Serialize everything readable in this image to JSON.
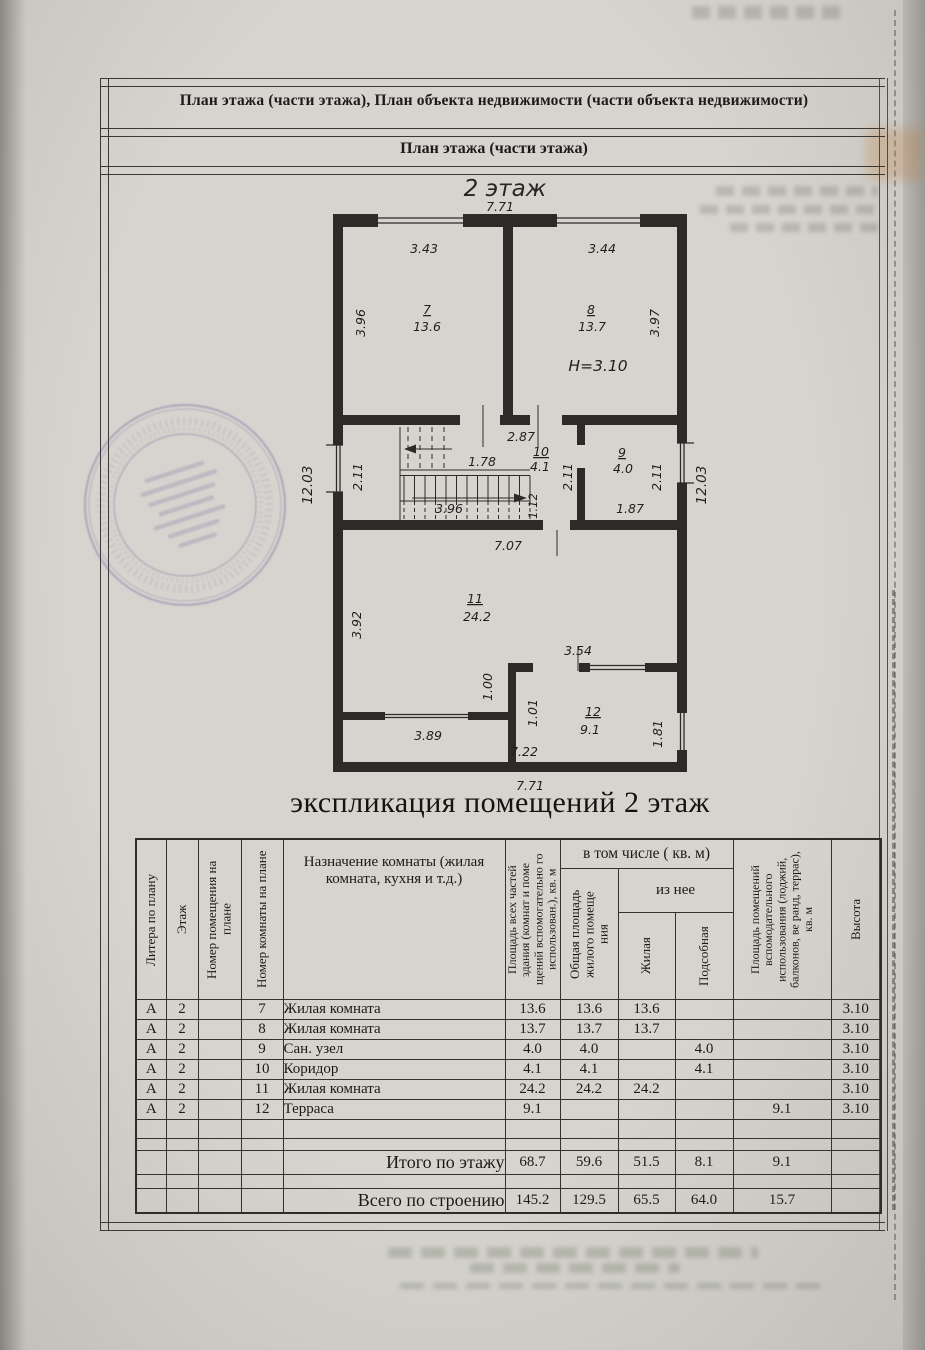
{
  "document": {
    "header_line1": "План этажа (части этажа), План объекта недвижимости (части объекта недвижимости)",
    "header_line2": "План этажа (части этажа)",
    "plan_floor_title": "2 этаж",
    "explication_title": "экспликация помещений 2  этаж"
  },
  "plan": {
    "labels": [
      {
        "t": "7.71",
        "x": 500,
        "y": 211
      },
      {
        "t": "3.43",
        "x": 424,
        "y": 253
      },
      {
        "t": "3.44",
        "x": 602,
        "y": 253
      },
      {
        "t": "3.96",
        "x": 365,
        "y": 323,
        "r": -90
      },
      {
        "t": "7",
        "x": 427,
        "y": 314,
        "u": 1
      },
      {
        "t": "13.6",
        "x": 427,
        "y": 331
      },
      {
        "t": "8",
        "x": 591,
        "y": 314,
        "u": 1
      },
      {
        "t": "13.7",
        "x": 592,
        "y": 331
      },
      {
        "t": "3.97",
        "x": 659,
        "y": 323,
        "r": -90
      },
      {
        "t": "H=3.10",
        "x": 598,
        "y": 371,
        "s": 15.5
      },
      {
        "t": "12.03",
        "x": 312,
        "y": 485,
        "r": -90,
        "s": 13.5
      },
      {
        "t": "2.11",
        "x": 362,
        "y": 477,
        "r": -90
      },
      {
        "t": "2.87",
        "x": 521,
        "y": 441
      },
      {
        "t": "1.78",
        "x": 482,
        "y": 466
      },
      {
        "t": "10",
        "x": 541,
        "y": 456,
        "u": 1
      },
      {
        "t": "4.1",
        "x": 540,
        "y": 471
      },
      {
        "t": "2.11",
        "x": 572,
        "y": 477,
        "r": -90
      },
      {
        "t": "9",
        "x": 622,
        "y": 457,
        "u": 1
      },
      {
        "t": "4.0",
        "x": 623,
        "y": 473
      },
      {
        "t": "2.11",
        "x": 661,
        "y": 477,
        "r": -90
      },
      {
        "t": "12.03",
        "x": 706,
        "y": 485,
        "r": -90,
        "s": 13.5
      },
      {
        "t": "3.96",
        "x": 449,
        "y": 513
      },
      {
        "t": "1.12",
        "x": 537,
        "y": 506,
        "r": -90,
        "s": 11.5
      },
      {
        "t": "1.87",
        "x": 630,
        "y": 513
      },
      {
        "t": "7.07",
        "x": 508,
        "y": 550
      },
      {
        "t": "11",
        "x": 475,
        "y": 603,
        "u": 1
      },
      {
        "t": "24.2",
        "x": 477,
        "y": 621
      },
      {
        "t": "3.92",
        "x": 361,
        "y": 625,
        "r": -90
      },
      {
        "t": "3.54",
        "x": 578,
        "y": 655
      },
      {
        "t": "1.00",
        "x": 492,
        "y": 687,
        "r": -90
      },
      {
        "t": "1.01",
        "x": 537,
        "y": 713,
        "r": -90
      },
      {
        "t": "12",
        "x": 593,
        "y": 716,
        "u": 1
      },
      {
        "t": "9.1",
        "x": 590,
        "y": 734
      },
      {
        "t": "1.81",
        "x": 662,
        "y": 734,
        "r": -90
      },
      {
        "t": "3.89",
        "x": 428,
        "y": 740
      },
      {
        "t": "7.22",
        "x": 524,
        "y": 756
      },
      {
        "t": "7.71",
        "x": 530,
        "y": 790
      }
    ]
  },
  "stamp": {
    "present": true,
    "legible": false,
    "color": "#5f5694"
  },
  "table": {
    "headers": {
      "col1": "Литера по плану",
      "col2": "Этаж",
      "col3": "Номер помещения на плане",
      "col4": "Номер комнаты на плане",
      "col5": "Назначение комнаты (жилая комната, кухня и т.д.)",
      "col6": "Площадь всех частей здания (комнат и поме щений вспомогательно го использован.), кв. м",
      "group_incl": "в том числе ( кв. м)",
      "col7": "Общая площадь жилого помеще ния",
      "group_iznee": "из нее",
      "col8": "Жилая",
      "col9": "Подсобная",
      "col10": "Площадь помещений вспомодательного использования (лоджий, балконов, ве ранд, террас), кв. м",
      "col11": "Высота"
    },
    "rows": [
      {
        "cells": [
          "А",
          "2",
          "",
          "7",
          "Жилая комната",
          "13.6",
          "13.6",
          "13.6",
          "",
          "",
          "3.10"
        ]
      },
      {
        "cells": [
          "А",
          "2",
          "",
          "8",
          "Жилая комната",
          "13.7",
          "13.7",
          "13.7",
          "",
          "",
          "3.10"
        ]
      },
      {
        "cells": [
          "А",
          "2",
          "",
          "9",
          "Сан. узел",
          "4.0",
          "4.0",
          "",
          "4.0",
          "",
          "3.10"
        ]
      },
      {
        "cells": [
          "А",
          "2",
          "",
          "10",
          "Коридор",
          "4.1",
          "4.1",
          "",
          "4.1",
          "",
          "3.10"
        ]
      },
      {
        "cells": [
          "А",
          "2",
          "",
          "11",
          "Жилая комната",
          "24.2",
          "24.2",
          "24.2",
          "",
          "",
          "3.10"
        ]
      },
      {
        "cells": [
          "А",
          "2",
          "",
          "12",
          "Терраса",
          "9.1",
          "",
          "",
          "",
          "9.1",
          "3.10"
        ]
      },
      {
        "cells": [
          "",
          "",
          "",
          "",
          "",
          "",
          "",
          "",
          "",
          "",
          ""
        ],
        "type": "empty",
        "h": 18
      },
      {
        "cells": [
          "",
          "",
          "",
          "",
          "",
          "",
          "",
          "",
          "",
          "",
          ""
        ],
        "type": "empty",
        "h": 11
      },
      {
        "cells": [
          "",
          "",
          "",
          "",
          "Итого по этажу",
          "68.7",
          "59.6",
          "51.5",
          "8.1",
          "9.1",
          ""
        ],
        "type": "total"
      },
      {
        "cells": [
          "",
          "",
          "",
          "",
          "",
          "",
          "",
          "",
          "",
          "",
          ""
        ],
        "type": "empty",
        "h": 13
      },
      {
        "cells": [
          "",
          "",
          "",
          "",
          "Всего по строению",
          "145.2",
          "129.5",
          "65.5",
          "64.0",
          "15.7",
          ""
        ],
        "type": "total"
      }
    ]
  },
  "colors": {
    "paper": "#d7d4cf",
    "line": "#34322c",
    "stamp": "#5f5694"
  }
}
